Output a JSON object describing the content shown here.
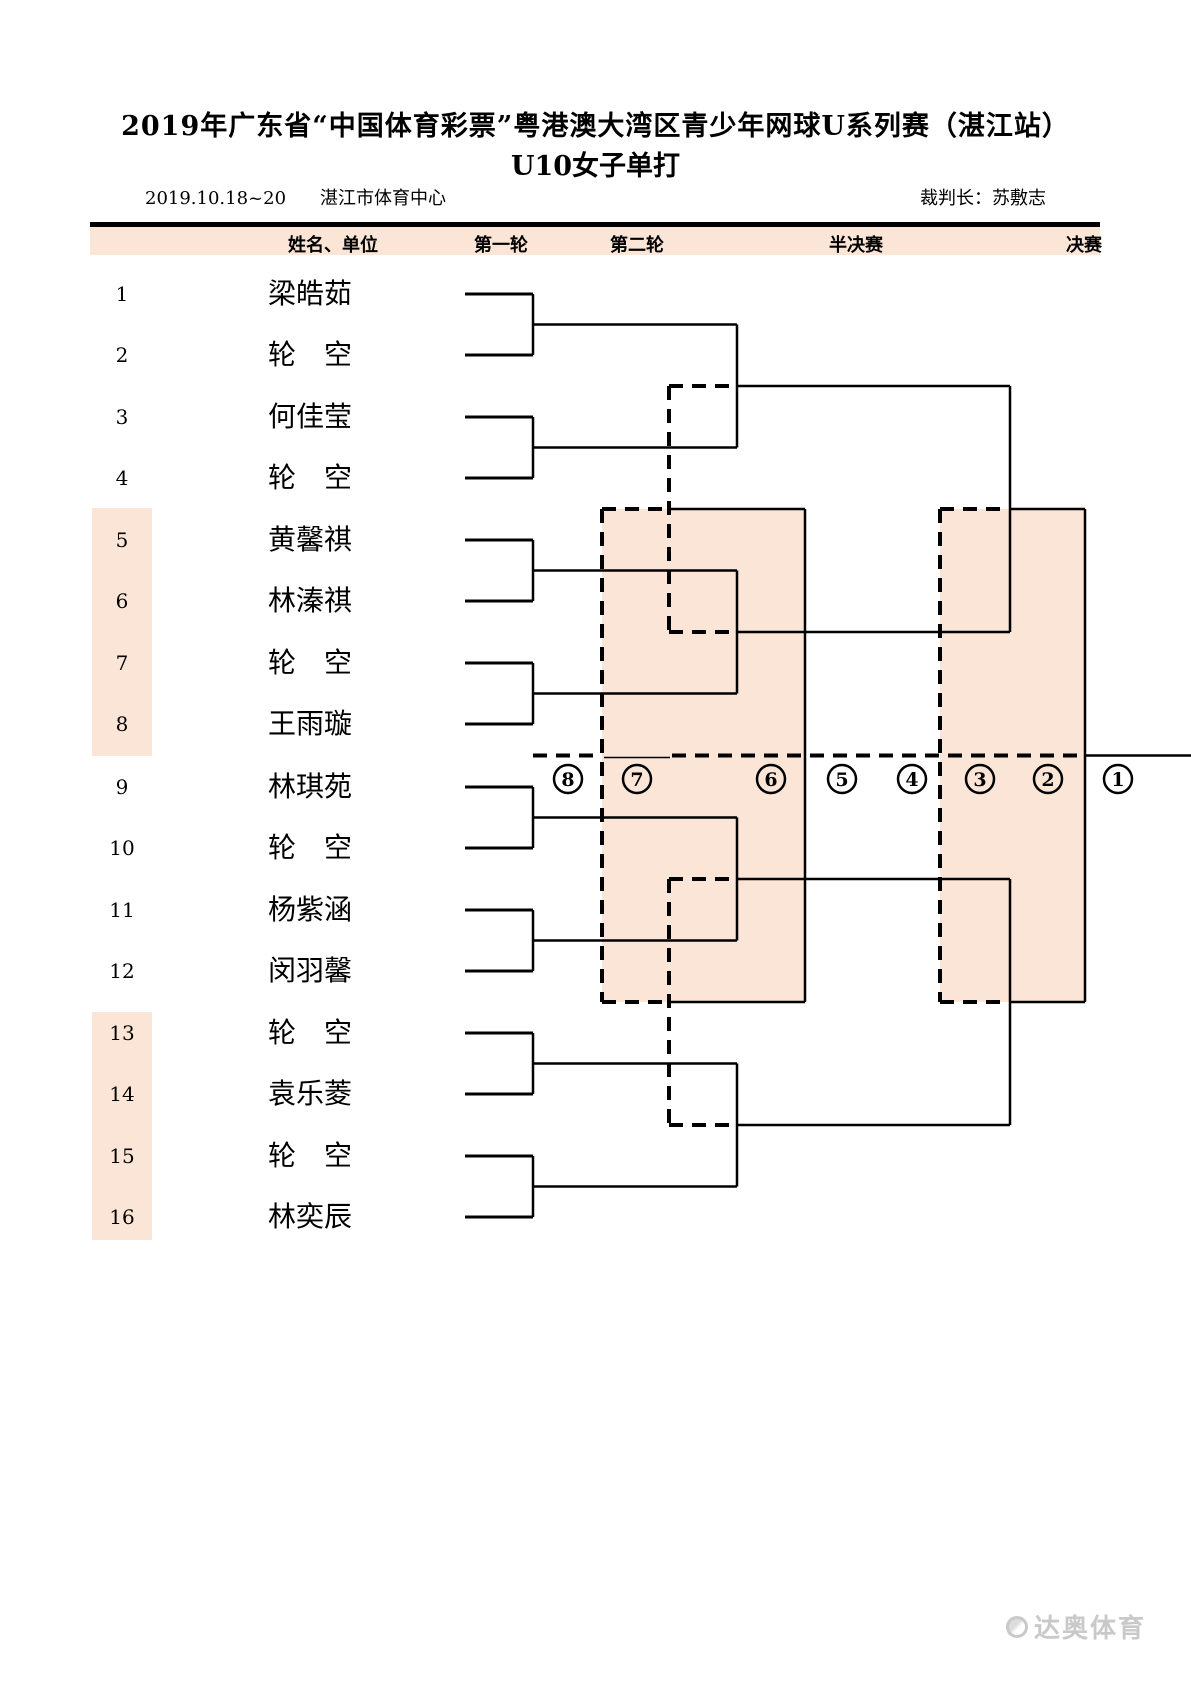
{
  "title": {
    "line1": "2019年广东省“中国体育彩票”粤港澳大湾区青少年网球U系列赛（湛江站）",
    "line2": "U10女子单打"
  },
  "info": {
    "dates": "2019.10.18~20",
    "venue": "湛江市体育中心",
    "referee": "裁判长：苏敷志"
  },
  "header": {
    "columns": [
      "姓名、单位",
      "第一轮",
      "第二轮",
      "半决赛",
      "决赛"
    ]
  },
  "players": [
    {
      "no": "1",
      "name": "梁皓茹"
    },
    {
      "no": "2",
      "name": "轮　空"
    },
    {
      "no": "3",
      "name": "何佳莹"
    },
    {
      "no": "4",
      "name": "轮　空"
    },
    {
      "no": "5",
      "name": "黄馨祺"
    },
    {
      "no": "6",
      "name": "林溱祺"
    },
    {
      "no": "7",
      "name": "轮　空"
    },
    {
      "no": "8",
      "name": "王雨璇"
    },
    {
      "no": "9",
      "name": "林琪苑"
    },
    {
      "no": "10",
      "name": "轮　空"
    },
    {
      "no": "11",
      "name": "杨紫涵"
    },
    {
      "no": "12",
      "name": "闵羽馨"
    },
    {
      "no": "13",
      "name": "轮　空"
    },
    {
      "no": "14",
      "name": "袁乐菱"
    },
    {
      "no": "15",
      "name": "轮　空"
    },
    {
      "no": "16",
      "name": "林奕辰"
    }
  ],
  "places": [
    "8",
    "7",
    "6",
    "5",
    "4",
    "3",
    "2",
    "1"
  ],
  "watermark": {
    "brand": "达奥体育"
  },
  "colors": {
    "band": "#fbe5d6",
    "highlight": "#fbe5d6",
    "line": "#000000"
  }
}
